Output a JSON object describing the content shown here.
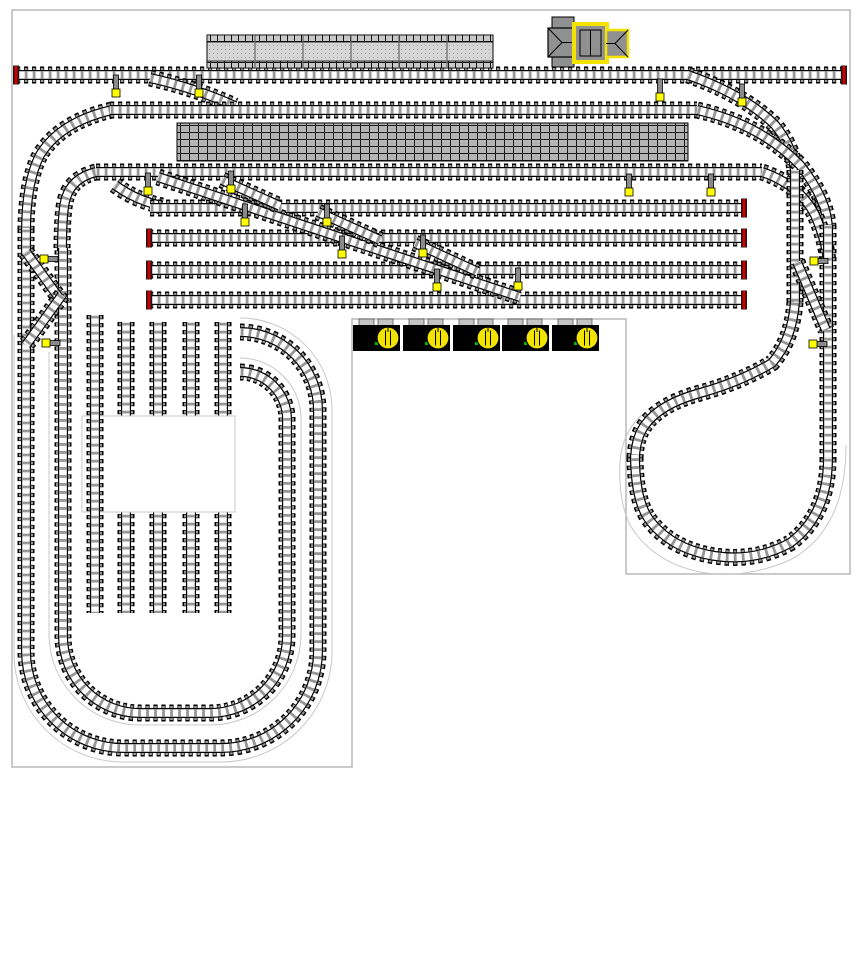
{
  "canvas": {
    "width": 862,
    "height": 962,
    "background": "#ffffff"
  },
  "colors": {
    "board_border": "#b8b8b8",
    "guide_line": "#c8c8c8",
    "tie_gray": "#969696",
    "rail_black": "#000000",
    "buffer_red": "#cc0000",
    "lever_yellow": "#ffff00",
    "lever_post_gray": "#8a8a8a",
    "platform_fill": "#d4d4d4",
    "platform_brick": "#b4b4b4",
    "building_gray": "#909090",
    "building_yellow": "#f2e300",
    "regulator_body": "#000000",
    "regulator_tab": "#c4c4c4",
    "regulator_dial": "#f2e300",
    "regulator_led": "#00bb00"
  },
  "board": {
    "outline_path": "M12,10 H850 V574 H626 V319 H352 V767 H12 Z"
  },
  "guides": [
    {
      "id": "guide-left-oval-outer",
      "d": "M240,318 A92,92 0 0 1 332,410 L332,651 A111,111 0 0 1 221,762 L123,762 A109,109 0 0 1 14,653 L14,335"
    },
    {
      "id": "guide-left-oval-inner",
      "d": "M240,358 A61,61 0 0 1 301,419 L301,634 A91,91 0 0 1 210,725 L140,725 A91,91 0 0 1 49,634 L49,352"
    },
    {
      "id": "guide-balloon",
      "d": "M846,445 Q846,530 790,560 Q744,580 700,572 Q652,562 630,525 Q618,500 620,462 Q622,432 643,414"
    }
  ],
  "tracks": [
    {
      "id": "curve-line2-to-left-loop",
      "d": "M112,110 Q60,122 40,155 Q26,182 26,232"
    },
    {
      "id": "outer-oval-loop",
      "d": "M240,332 A78,78 0 0 1 318,410 L318,651 A97,97 0 0 1 221,748 L123,748 A97,97 0 0 1 26,651 L26,228"
    },
    {
      "id": "curve-line3-to-left-loop",
      "d": "M96,172 Q72,178 66,198 Q62,210 62,252"
    },
    {
      "id": "inner-oval-loop",
      "d": "M240,372 A47,47 0 0 1 287,419 L287,636 A77,77 0 0 1 210,713 L140,713 A77,77 0 0 1 63,636 L63,248"
    },
    {
      "id": "left-crossover-1",
      "d": "M26,252 L62,302"
    },
    {
      "id": "left-crossover-2",
      "d": "M62,295 L26,345"
    },
    {
      "id": "main-line-1",
      "d": "M16,75 L844,75"
    },
    {
      "id": "diag-line1-line2",
      "d": "M150,78 Q195,88 235,106"
    },
    {
      "id": "main-line-2",
      "d": "M110,110 L697,110"
    },
    {
      "id": "main-line-3",
      "d": "M96,172 L762,172"
    },
    {
      "id": "conn-line4-left",
      "d": "M115,185 Q135,200 162,206"
    },
    {
      "id": "yard-line-4",
      "d": "M150,208 L744,208"
    },
    {
      "id": "yard-line-5",
      "d": "M149,238 L744,238"
    },
    {
      "id": "yard-line-6",
      "d": "M149,270 L744,270"
    },
    {
      "id": "yard-line-7",
      "d": "M149,300 L744,300"
    },
    {
      "id": "yard-ladder-main",
      "d": "M158,177 L520,297"
    },
    {
      "id": "yard-ladder-a",
      "d": "M222,180 L280,206"
    },
    {
      "id": "yard-ladder-b",
      "d": "M318,212 L380,240"
    },
    {
      "id": "yard-ladder-c",
      "d": "M415,243 L478,272"
    },
    {
      "id": "diag-line1-right",
      "d": "M688,75 Q745,95 775,125 Q795,150 795,175"
    },
    {
      "id": "curve-line2-right",
      "d": "M697,110 Q760,124 800,165 Q828,200 828,230"
    },
    {
      "id": "curve-line3-right",
      "d": "M762,172 Q800,185 815,215 Q826,240 828,262"
    },
    {
      "id": "right-vertical-inner",
      "d": "M795,170 L795,302"
    },
    {
      "id": "right-vertical-outer",
      "d": "M828,225 L828,458"
    },
    {
      "id": "right-arm-crossover",
      "d": "M797,262 L826,330"
    },
    {
      "id": "balloon-s-curve",
      "d": "M795,302 Q792,340 772,363 Q740,382 700,393 Q660,404 645,425 Q636,437 635,458"
    },
    {
      "id": "balloon-loop",
      "d": "M828,458 Q828,515 790,543 Q755,562 715,556 Q670,549 648,518 Q635,498 635,455"
    },
    {
      "id": "siding-2",
      "d": "M126,322 L126,613"
    },
    {
      "id": "siding-3",
      "d": "M158,322 L158,613"
    },
    {
      "id": "siding-4",
      "d": "M191,322 L191,613"
    },
    {
      "id": "siding-5",
      "d": "M223,322 L223,613"
    },
    {
      "id": "siding-1",
      "d": "M95,315 L95,613",
      "top": true
    }
  ],
  "white_rect": {
    "x": 82,
    "y": 416,
    "w": 153,
    "h": 96
  },
  "buffers": [
    {
      "x": 16,
      "y": 75
    },
    {
      "x": 844,
      "y": 75
    },
    {
      "x": 744,
      "y": 208
    },
    {
      "x": 149,
      "y": 238
    },
    {
      "x": 744,
      "y": 238
    },
    {
      "x": 149,
      "y": 270
    },
    {
      "x": 744,
      "y": 270
    },
    {
      "x": 149,
      "y": 300
    },
    {
      "x": 744,
      "y": 300
    }
  ],
  "levers": [
    {
      "x": 116,
      "y": 93,
      "dir": "v"
    },
    {
      "x": 199,
      "y": 93,
      "dir": "v"
    },
    {
      "x": 660,
      "y": 97,
      "dir": "v"
    },
    {
      "x": 742,
      "y": 102,
      "dir": "v"
    },
    {
      "x": 629,
      "y": 192,
      "dir": "v"
    },
    {
      "x": 711,
      "y": 192,
      "dir": "v"
    },
    {
      "x": 148,
      "y": 191,
      "dir": "v"
    },
    {
      "x": 231,
      "y": 189,
      "dir": "v"
    },
    {
      "x": 245,
      "y": 222,
      "dir": "v"
    },
    {
      "x": 327,
      "y": 222,
      "dir": "v"
    },
    {
      "x": 342,
      "y": 254,
      "dir": "v"
    },
    {
      "x": 423,
      "y": 253,
      "dir": "v"
    },
    {
      "x": 437,
      "y": 287,
      "dir": "v"
    },
    {
      "x": 518,
      "y": 286,
      "dir": "v"
    },
    {
      "x": 44,
      "y": 259,
      "dir": "hr"
    },
    {
      "x": 46,
      "y": 343,
      "dir": "hr"
    },
    {
      "x": 814,
      "y": 261,
      "dir": "hr"
    },
    {
      "x": 813,
      "y": 344,
      "dir": "hr"
    }
  ],
  "platform_top": {
    "x": 207,
    "y": 35,
    "w": 286,
    "h": 33,
    "dividers_x": [
      255,
      303,
      351,
      399,
      447
    ]
  },
  "platform_brick": {
    "x": 177,
    "y": 123,
    "w": 511,
    "h": 38
  },
  "station_building": {
    "tab_top": {
      "x": 552,
      "y": 17,
      "w": 22,
      "h": 12
    },
    "tab_bottom": {
      "x": 552,
      "y": 55,
      "w": 22,
      "h": 12
    },
    "left_wing": {
      "x": 548,
      "y": 28,
      "w": 29,
      "h": 29
    },
    "center": {
      "x": 574,
      "y": 24,
      "w": 33,
      "h": 38
    },
    "center_inner": {
      "x": 580,
      "y": 30,
      "w": 21,
      "h": 26
    },
    "right_wing": {
      "x": 606,
      "y": 30,
      "w": 22,
      "h": 27
    }
  },
  "regulators": {
    "xs": [
      353,
      403,
      453,
      502,
      552
    ],
    "body": {
      "y": 325,
      "w": 47,
      "h": 26
    },
    "tabs_y": 319,
    "tab_w": 15,
    "tab_h": 7,
    "dial": {
      "dx": 35,
      "cy": 338,
      "r": 11
    },
    "led": {
      "dx": 22,
      "y": 342,
      "s": 3
    }
  }
}
